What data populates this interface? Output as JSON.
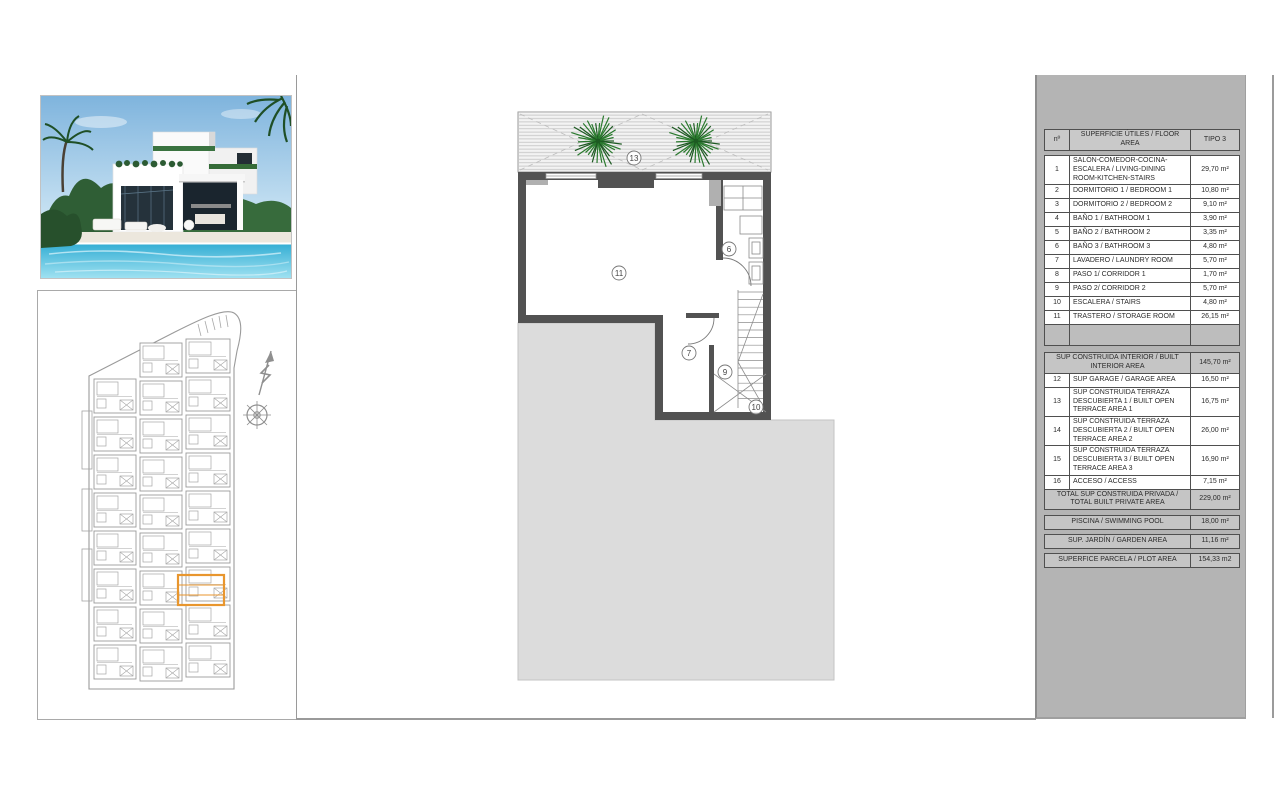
{
  "plan_labels": {
    "terrace": "13",
    "storage_room": "11",
    "bathroom3": "6",
    "laundry": "7",
    "corridor2": "9",
    "stairs": "10"
  },
  "area_table": {
    "header": {
      "no": "nº",
      "name": "SUPERFICIE ÚTILES / FLOOR AREA",
      "type": "TIPO 3"
    },
    "rows": [
      {
        "no": "1",
        "name": "SALÓN-COMEDOR-COCINA-ESCALERA / LIVING-DINING ROOM-KITCHEN-STAIRS",
        "value": "29,70 m²"
      },
      {
        "no": "2",
        "name": "DORMITORIO 1 / BEDROOM 1",
        "value": "10,80 m²"
      },
      {
        "no": "3",
        "name": "DORMITORIO 2 / BEDROOM 2",
        "value": "9,10 m²"
      },
      {
        "no": "4",
        "name": "BAÑO 1 / BATHROOM 1",
        "value": "3,90 m²"
      },
      {
        "no": "5",
        "name": "BAÑO 2 / BATHROOM 2",
        "value": "3,35 m²"
      },
      {
        "no": "6",
        "name": "BAÑO 3 / BATHROOM 3",
        "value": "4,80 m²"
      },
      {
        "no": "7",
        "name": "LAVADERO / LAUNDRY ROOM",
        "value": "5,70 m²"
      },
      {
        "no": "8",
        "name": "PASO 1/ CORRIDOR 1",
        "value": "1,70 m²"
      },
      {
        "no": "9",
        "name": "PASO 2/ CORRIDOR 2",
        "value": "5,70 m²"
      },
      {
        "no": "10",
        "name": "ESCALERA / STAIRS",
        "value": "4,80 m²"
      },
      {
        "no": "11",
        "name": "TRASTERO / STORAGE ROOM",
        "value": "26,15 m²"
      }
    ],
    "interior_total": {
      "name": "SUP CONSTRUIDA INTERIOR / BUILT INTERIOR AREA",
      "value": "145,70 m²"
    },
    "rows2": [
      {
        "no": "12",
        "name": "SUP GARAGE / GARAGE AREA",
        "value": "16,50 m²"
      },
      {
        "no": "13",
        "name": "SUP CONSTRUIDA TERRAZA DESCUBIERTA 1 / BUILT OPEN TERRACE AREA 1",
        "value": "16,75 m²"
      },
      {
        "no": "14",
        "name": "SUP CONSTRUIDA TERRAZA DESCUBIERTA 2 / BUILT OPEN TERRACE AREA 2",
        "value": "26,00 m²"
      },
      {
        "no": "15",
        "name": "SUP CONSTRUIDA TERRAZA DESCUBIERTA 3 / BUILT OPEN TERRACE AREA 3",
        "value": "16,90 m²"
      },
      {
        "no": "16",
        "name": "ACCESO / ACCESS",
        "value": "7,15 m²"
      }
    ],
    "private_total": {
      "name": "TOTAL SUP CONSTRUIDA PRIVADA / TOTAL BUILT PRIVATE AREA",
      "value": "229,00 m²"
    },
    "pool": {
      "name": "PISCINA / SWIMMING POOL",
      "value": "18,00 m²"
    },
    "garden": {
      "name": "SUP. JARDÍN / GARDEN AREA",
      "value": "11,16 m²"
    },
    "plot": {
      "name": "SUPERFICE PARCELA / PLOT AREA",
      "value": "154,33 m2"
    }
  },
  "colors": {
    "highlight_orange": "#E8962E",
    "wall_gray": "#525252",
    "plot_fill": "#DCDCDC",
    "panel_gray": "#B4B4B4",
    "tree_green": "#2A7A2E"
  }
}
